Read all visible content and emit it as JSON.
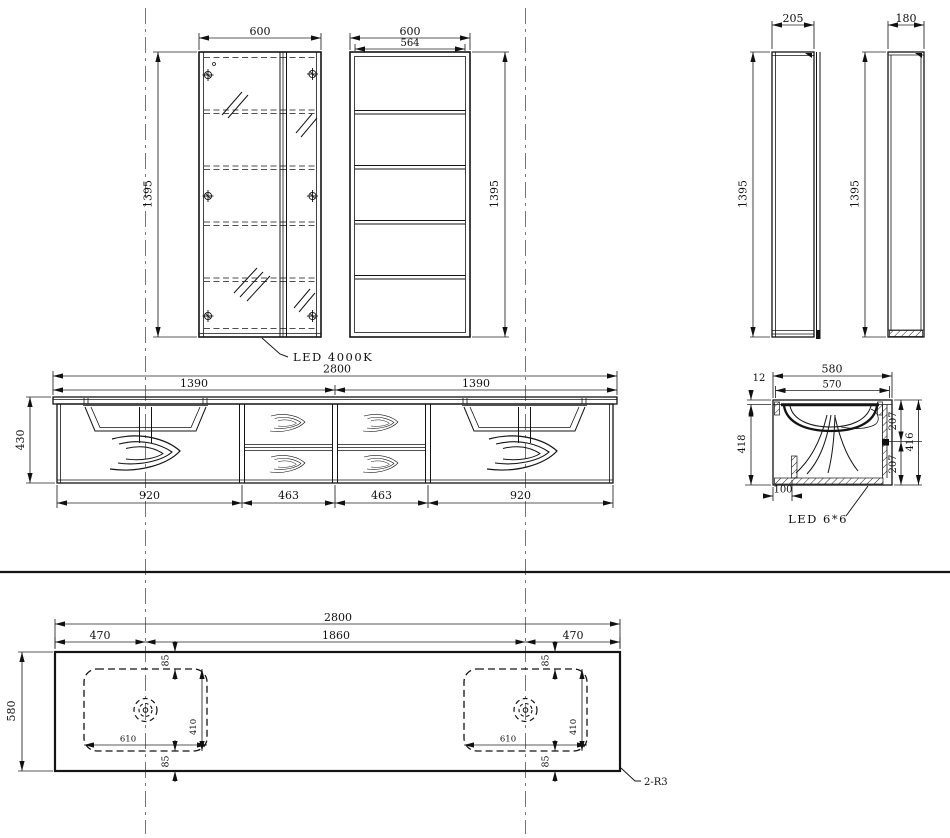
{
  "drawing": {
    "views": {
      "mirror_front": {
        "width": "600",
        "height": "1395",
        "led_label": "LED 4000K"
      },
      "shelf_front": {
        "width": "600",
        "inner_width": "564",
        "height": "1395"
      },
      "mirror_side": {
        "width": "205",
        "height": "1395"
      },
      "shelf_side": {
        "width": "180",
        "height": "1395"
      },
      "vanity_front": {
        "overall_width": "2800",
        "left_span": "1390",
        "right_span": "1390",
        "height": "430",
        "door_left": "920",
        "drawer_col_left": "463",
        "drawer_col_right": "463",
        "door_right": "920"
      },
      "vanity_section": {
        "depth": "580",
        "inner_depth": "570",
        "counter_thickness": "12",
        "left_height": "418",
        "upper_section": "207",
        "lower_section": "207",
        "right_height": "416",
        "toe_offset": "100",
        "led_label": "LED 6*6"
      },
      "counter_plan": {
        "overall_width": "2800",
        "left_offset": "470",
        "center_span": "1860",
        "right_offset": "470",
        "depth": "580",
        "edge_margin": "85",
        "cutout_width": "610",
        "cutout_depth": "410",
        "corner_note": "2-R3"
      }
    }
  }
}
